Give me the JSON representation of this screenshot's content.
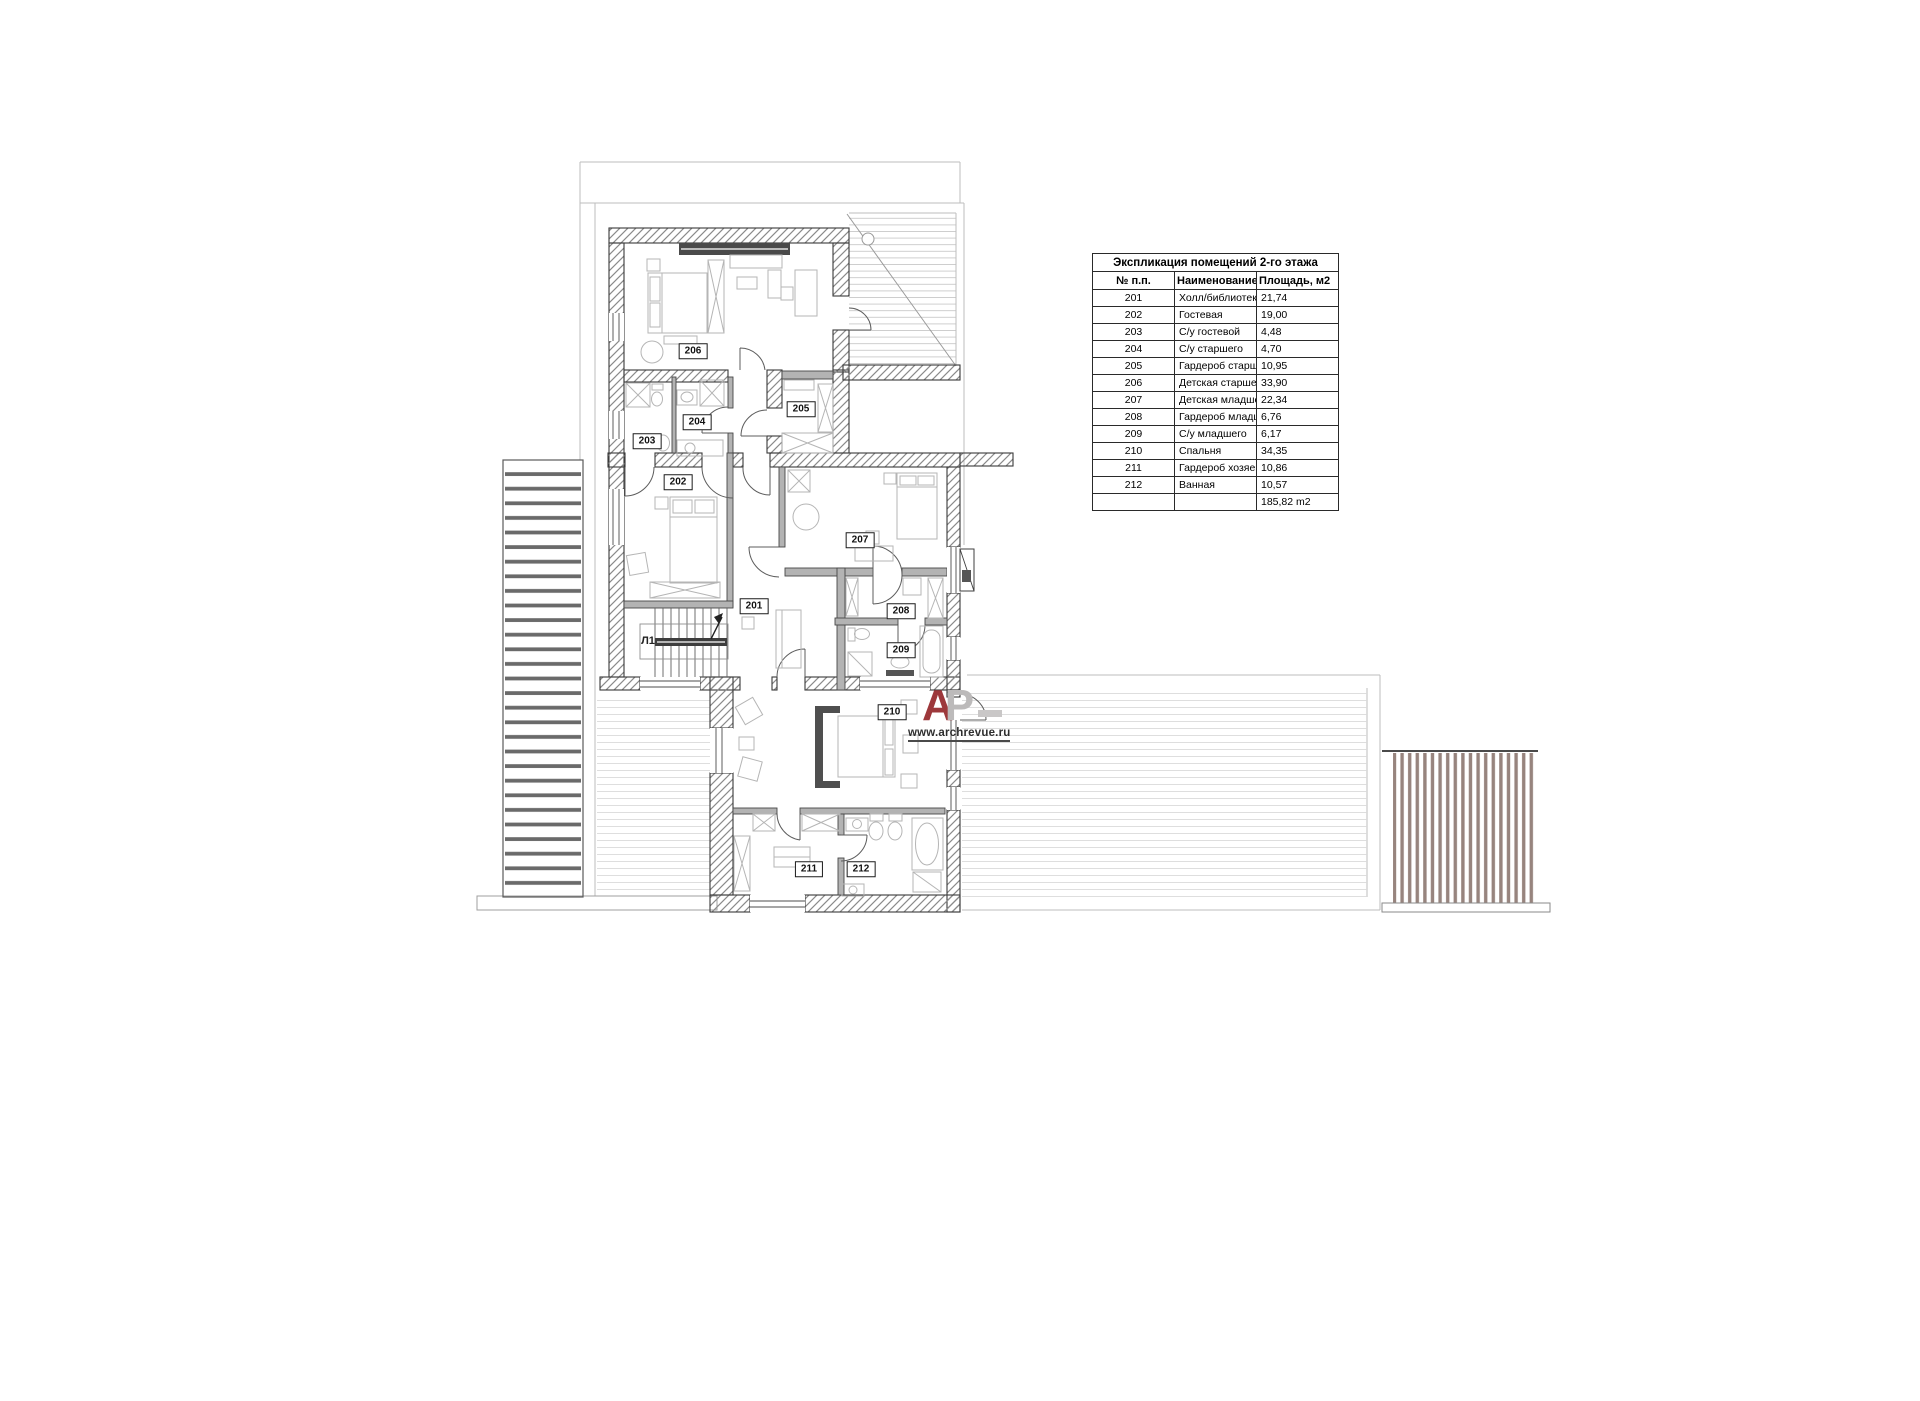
{
  "table": {
    "title": "Экспликация помещений 2-го этажа",
    "headers": [
      "№ п.п.",
      "Наименование",
      "Площадь, м2"
    ],
    "rows": [
      [
        "201",
        "Холл/библиотека",
        "21,74"
      ],
      [
        "202",
        "Гостевая",
        "19,00"
      ],
      [
        "203",
        "С/у гостевой",
        "4,48"
      ],
      [
        "204",
        "С/у старшего",
        "4,70"
      ],
      [
        "205",
        "Гардероб старшего",
        "10,95"
      ],
      [
        "206",
        "Детская старшего",
        "33,90"
      ],
      [
        "207",
        "Детская младшего",
        "22,34"
      ],
      [
        "208",
        "Гардероб младшего",
        "6,76"
      ],
      [
        "209",
        "С/у младшего",
        "6,17"
      ],
      [
        "210",
        "Спальня",
        "34,35"
      ],
      [
        "211",
        "Гардероб хозяев",
        "10,86"
      ],
      [
        "212",
        "Ванная",
        "10,57"
      ],
      [
        "",
        "",
        "185,82 m2"
      ]
    ]
  },
  "plan": {
    "room_labels": [
      "201",
      "202",
      "203",
      "204",
      "205",
      "206",
      "207",
      "208",
      "209",
      "210",
      "211",
      "212"
    ],
    "stair_label": "Л1"
  },
  "watermark": {
    "letter_a": "А",
    "letter_p": "Р",
    "url": "www.archrevue.ru",
    "red": "#9d383b",
    "gray": "#bcbaba"
  }
}
